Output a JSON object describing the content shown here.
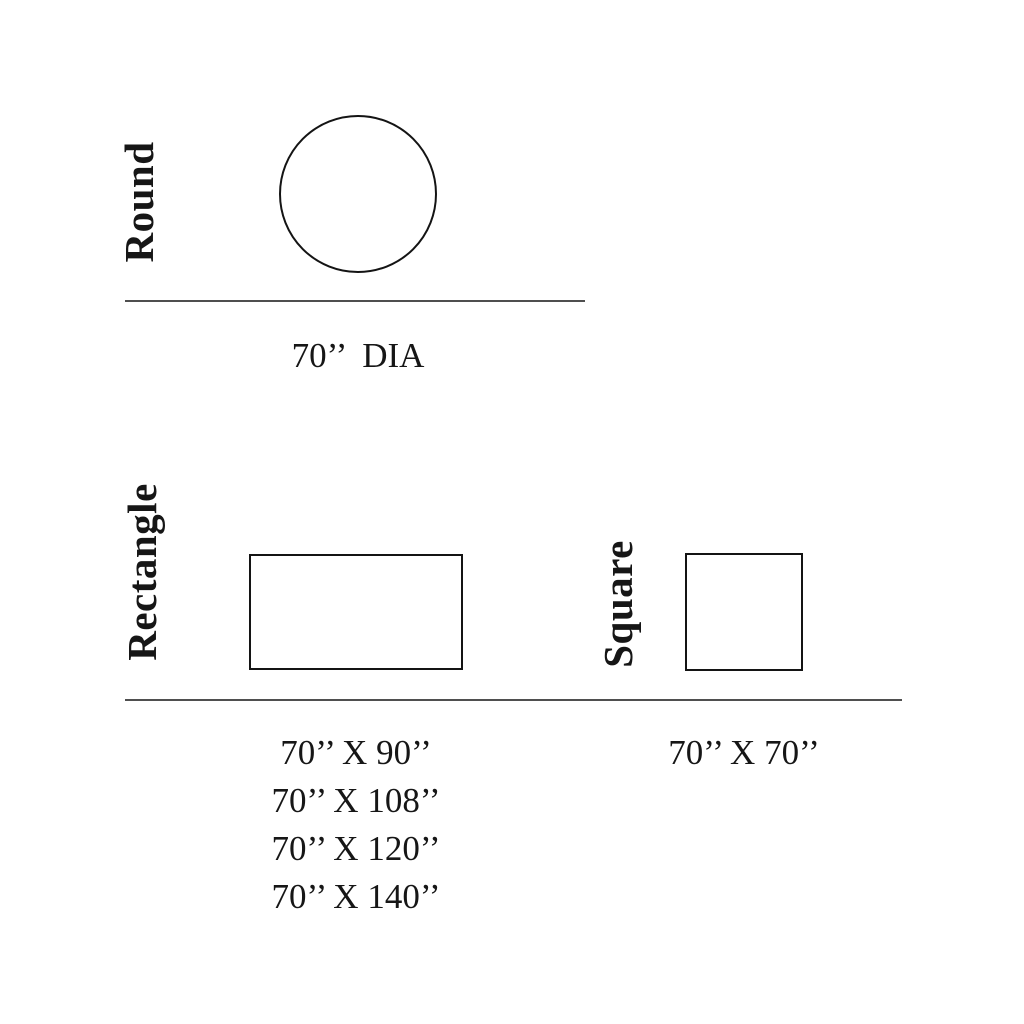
{
  "canvas": {
    "background": "#ffffff",
    "text_color": "#161616",
    "shape_stroke_color": "#141414",
    "divider_color": "#4f4f4f"
  },
  "sections": {
    "round": {
      "label": "Round",
      "shape": "circle",
      "size_note": "70’’  DIA"
    },
    "rectangle": {
      "label": "Rectangle",
      "shape": "rectangle",
      "sizes": [
        "70’’ X 90’’",
        "70’’ X 108’’",
        "70’’ X 120’’",
        "70’’ X 140’’"
      ]
    },
    "square": {
      "label": "Square",
      "shape": "square",
      "size_note": "70’’ X 70’’"
    }
  }
}
